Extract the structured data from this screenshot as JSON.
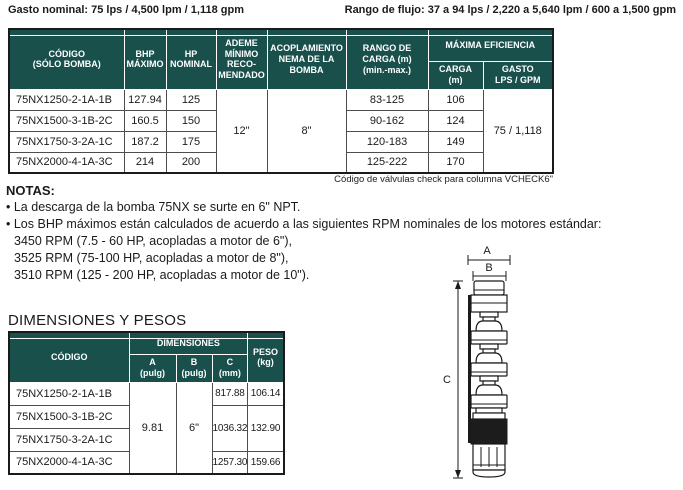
{
  "colors": {
    "header_teal": "#19504c",
    "table_border": "#1a1a1a",
    "cell_border": "#4d4d4d"
  },
  "page": {
    "gasto_nominal": "Gasto nominal: 75 lps / 4,500 lpm / 1,118 gpm",
    "rango_flujo": "Rango de flujo: 37 a 94 lps / 2,220 a 5,640 lpm / 600 a 1,500 gpm"
  },
  "main_table": {
    "headers": {
      "codigo": "CÓDIGO\n(SÓLO BOMBA)",
      "bhp": "BHP\nMÁXIMO",
      "hp": "HP\nNOMINAL",
      "ademe": "ADEME\nMÍNIMO\nRECO-\nMENDADO",
      "acoplamiento": "ACOPLAMIENTO\nNEMA DE LA\nBOMBA",
      "rango": "RANGO DE\nCARGA (m)\n(min.-max.)",
      "maxima_eficiencia": "MÁXIMA EFICIENCIA",
      "carga": "CARGA\n(m)",
      "gasto": "GASTO\nLPS / GPM"
    },
    "merged": {
      "ademe": "12\"",
      "acoplamiento": "8\"",
      "gasto": "75 / 1,118"
    },
    "rows": [
      {
        "codigo": "75NX1250-2-1A-1B",
        "bhp": "127.94",
        "hp": "125",
        "rango": "83-125",
        "carga": "106"
      },
      {
        "codigo": "75NX1500-3-1B-2C",
        "bhp": "160.5",
        "hp": "150",
        "rango": "90-162",
        "carga": "124"
      },
      {
        "codigo": "75NX1750-3-2A-1C",
        "bhp": "187.2",
        "hp": "175",
        "rango": "120-183",
        "carga": "149"
      },
      {
        "codigo": "75NX2000-4-1A-3C",
        "bhp": "214",
        "hp": "200",
        "rango": "125-222",
        "carga": "170"
      }
    ],
    "footnote": "Código de válvulas check para columna VCHECK6\""
  },
  "notas": {
    "title": "NOTAS:",
    "bullets": [
      "La descarga de la bomba 75NX se surte en 6\" NPT.",
      "Los BHP máximos están calculados de acuerdo a las siguientes RPM nominales de los motores estándar:"
    ],
    "rpm_lines": [
      "3450 RPM (7.5 - 60 HP, acopladas a motor de 6\"),",
      "3525 RPM (75-100 HP, acopladas a motor de 8\"),",
      "3510 RPM (125 - 200 HP, acopladas a motor de 10\")."
    ]
  },
  "dimensiones": {
    "title": "DIMENSIONES Y PESOS",
    "headers": {
      "codigo": "CÓDIGO",
      "dimensiones": "DIMENSIONES",
      "a": "A\n(pulg)",
      "b": "B\n(pulg)",
      "c": "C\n(mm)",
      "peso": "PESO\n(kg)"
    },
    "merged": {
      "a": "9.81",
      "b": "6\""
    },
    "rows": [
      {
        "codigo": "75NX1250-2-1A-1B",
        "c": "817.88",
        "peso": "106.14"
      },
      {
        "codigo": "75NX1500-3-1B-2C",
        "c": "1036.32",
        "peso": "132.90"
      },
      {
        "codigo": "75NX1750-3-2A-1C",
        "c": "",
        "peso": ""
      },
      {
        "codigo": "75NX2000-4-1A-3C",
        "c": "1257.30",
        "peso": "159.66"
      }
    ]
  },
  "diagram": {
    "label_a": "A",
    "label_b": "B",
    "label_c": "C"
  }
}
